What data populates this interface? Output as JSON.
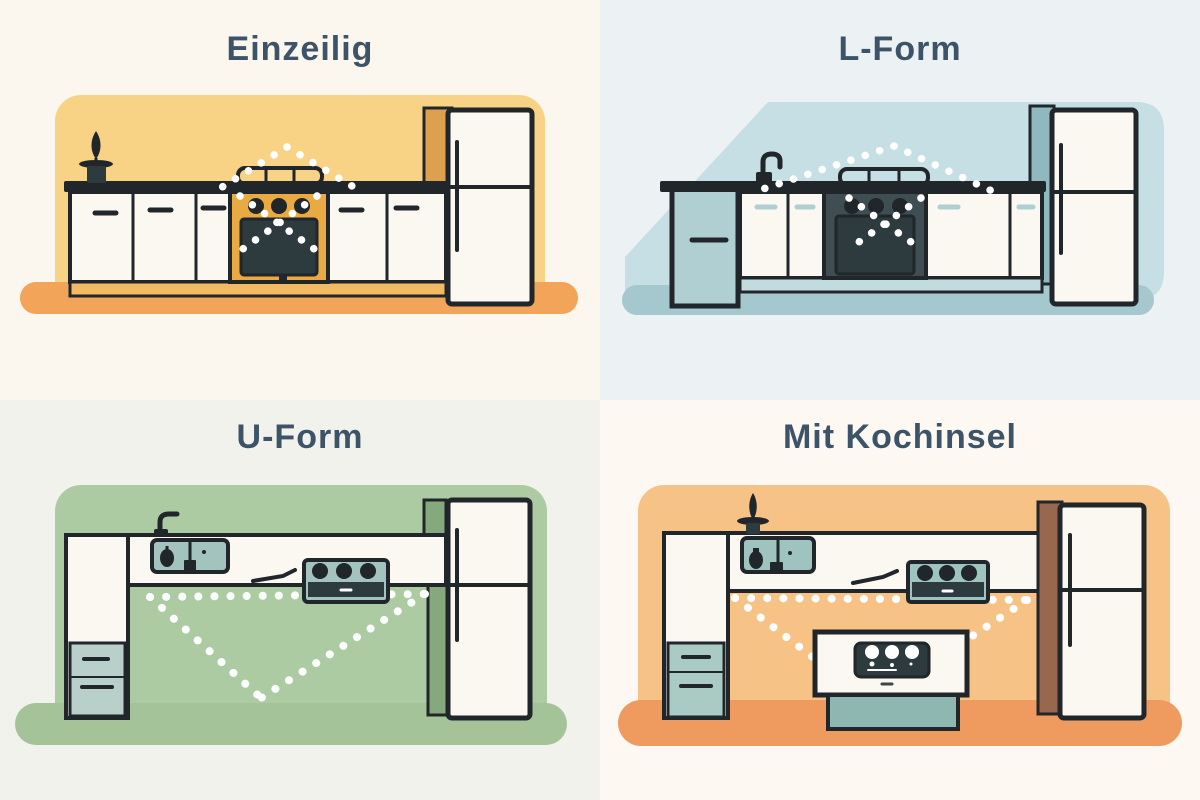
{
  "page": {
    "colors": {
      "title": "#3D5468",
      "outline": "#20262A",
      "cabinet": "#FAF8F1",
      "oven": "#2D3A3E",
      "dot": "#FFFFFF"
    }
  },
  "panels": [
    {
      "id": "einzeilig",
      "title": "Einzeilig",
      "icons": [
        "plant-icon",
        "stove-icon",
        "oven-icon",
        "fridge-icon",
        "work-triangle"
      ],
      "colors": {
        "paper": "#FBF6EE",
        "bg": "#F8D285",
        "floor": "#F2A459",
        "accent": "#E9A943",
        "kick": "#F2BA62",
        "tall": "#DCA04F"
      }
    },
    {
      "id": "l-form",
      "title": "L-Form",
      "icons": [
        "faucet-icon",
        "dishwasher-icon",
        "stove-icon",
        "oven-icon",
        "fridge-icon",
        "work-triangle"
      ],
      "colors": {
        "paper": "#ECF1F4",
        "bg": "#C6DFE5",
        "floor": "#A5C7CE",
        "appl": "#AFCFD2",
        "kick": "#C2DBDF",
        "tall": "#8FB9BF",
        "recess": "#3E4E52"
      }
    },
    {
      "id": "u-form",
      "title": "U-Form",
      "icons": [
        "faucet-icon",
        "sink-icon",
        "kettle-icon",
        "utensil-icon",
        "cooktop-icon",
        "drawer-cabinet-icon",
        "fridge-icon",
        "work-triangle"
      ],
      "colors": {
        "paper": "#F1F2EC",
        "bg": "#ADCBA3",
        "floor": "#A5C399",
        "appl": "#A2C3BE",
        "drawers": "#B9D0CA",
        "strip": "#85A87C"
      }
    },
    {
      "id": "mit-kochinsel",
      "title": "Mit Kochinsel",
      "icons": [
        "plant-icon",
        "sink-icon",
        "utensil-icon",
        "cooktop-icon",
        "drawer-cabinet-icon",
        "fridge-icon",
        "kitchen-island-icon",
        "oven-icon",
        "work-triangle"
      ],
      "colors": {
        "paper": "#FDF8F1",
        "bg": "#F7C286",
        "floor": "#EF9A5F",
        "appl": "#9FC4C0",
        "drawers": "#A9CBC4",
        "tall": "#99674E",
        "base": "#8FB7B2"
      }
    }
  ]
}
